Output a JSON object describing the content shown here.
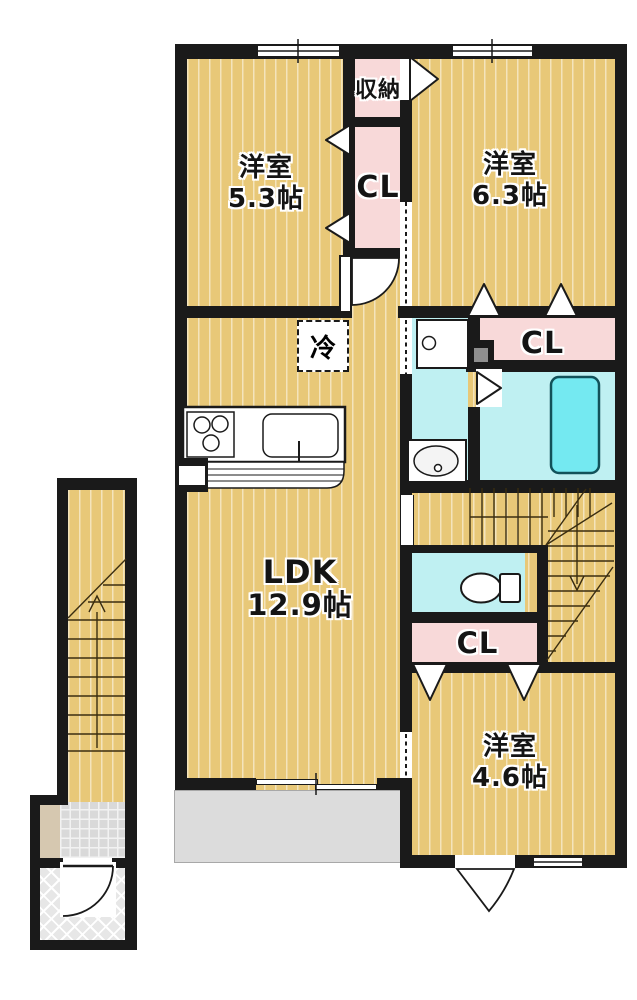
{
  "plan": {
    "rooms": [
      {
        "name": "洋室",
        "size": "5.3帖"
      },
      {
        "name": "洋室",
        "size": "6.3帖"
      },
      {
        "name": "LDK",
        "size": "12.9帖"
      },
      {
        "name": "洋室",
        "size": "4.6帖"
      }
    ],
    "closets": {
      "storage": "収納",
      "upper": "CL",
      "bath": "CL",
      "hall": "CL"
    },
    "fixtures": {
      "fridge": "冷"
    },
    "colors": {
      "floor": "#e8c878",
      "wall": "#1a1a1a",
      "closet_pink": "#f8d9d9",
      "wet_area_cyan": "#bff0f2",
      "bathtub": "#74e9f1",
      "balcony_gray": "#dcdcdc",
      "entrance_tile": "#d9d9d9",
      "shoe_cabinet_beige": "#d6c8b0"
    }
  }
}
